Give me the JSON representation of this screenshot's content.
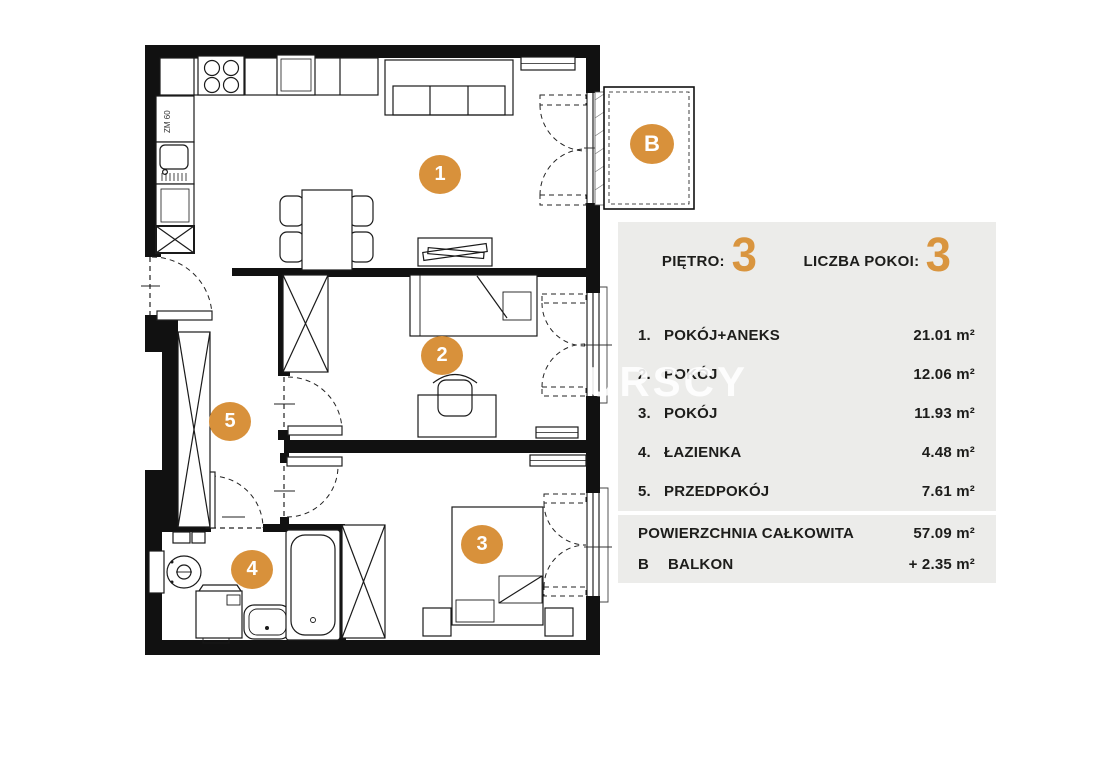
{
  "plan": {
    "watermark": "URSCY",
    "kitchen_label": "ZM 60",
    "markers": [
      "1",
      "2",
      "3",
      "4",
      "5"
    ],
    "balcony_marker": "B"
  },
  "panel": {
    "floor": {
      "label": "PIĘTRO:",
      "value": "3"
    },
    "rooms": {
      "label": "LICZBA POKOI:",
      "value": "3"
    },
    "legend": [
      {
        "num": "1.",
        "name": "POKÓJ+ANEKS",
        "area": "21.01 m²"
      },
      {
        "num": "2.",
        "name": "POKÓJ",
        "area": "12.06 m²"
      },
      {
        "num": "3.",
        "name": "POKÓJ",
        "area": "11.93 m²"
      },
      {
        "num": "4.",
        "name": "ŁAZIENKA",
        "area": "4.48 m²"
      },
      {
        "num": "5.",
        "name": "PRZEDPOKÓJ",
        "area": "7.61 m²"
      }
    ],
    "totals": [
      {
        "num": "",
        "name": "POWIERZCHNIA CAŁKOWITA",
        "area": "57.09 m²"
      },
      {
        "num": "B",
        "name": "BALKON",
        "area": "+ 2.35 m²"
      }
    ]
  },
  "colors": {
    "accent": "#D8913B",
    "panel_bg": "#ECECEA",
    "text": "#1D1D1B"
  }
}
